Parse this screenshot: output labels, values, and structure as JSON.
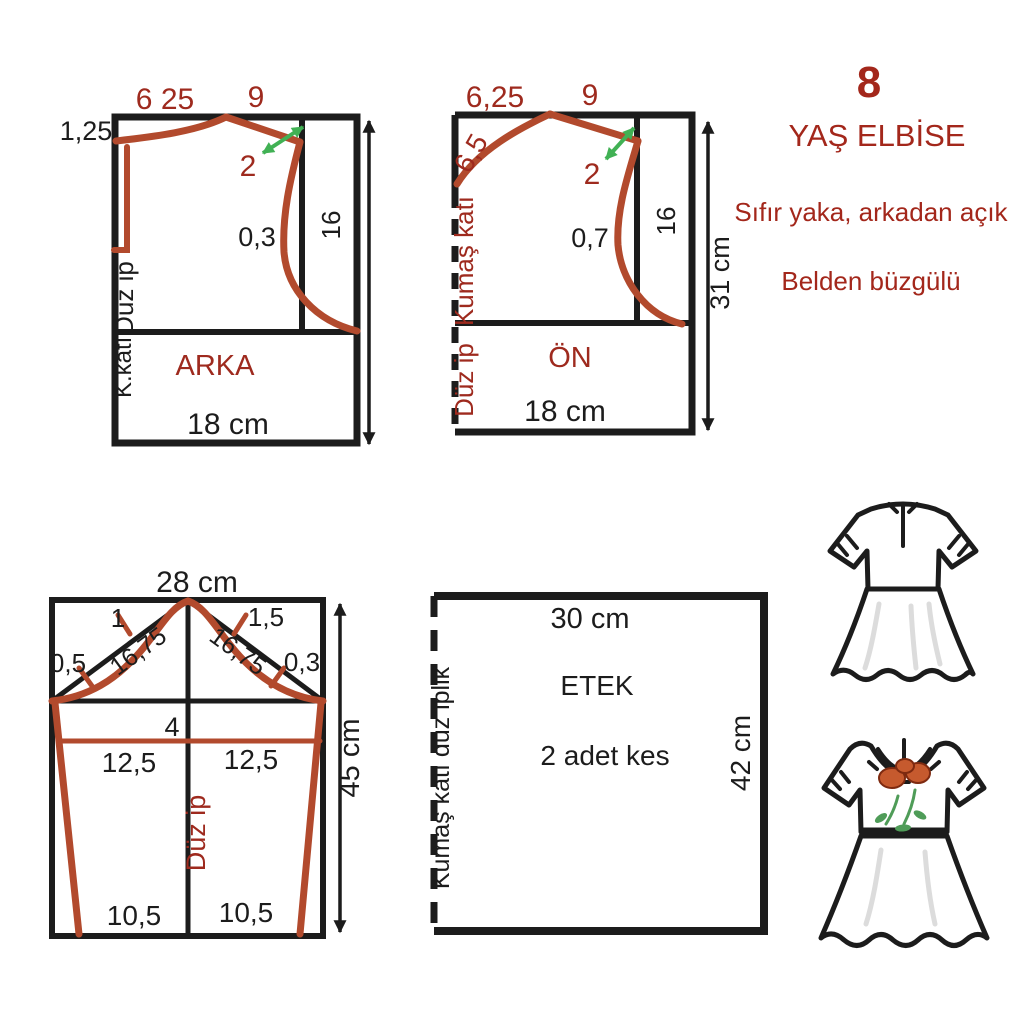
{
  "colors": {
    "ink": "#1c1c1c",
    "red-line": "#b24a2d",
    "red-text": "#9e2a1e",
    "title-red": "#a3271b",
    "green": "#41b154",
    "flower-red": "#c65a2e",
    "flower-green": "#4f9c58",
    "bg": "#ffffff"
  },
  "header": {
    "size_number": "8",
    "title": "YAŞ ELBİSE",
    "subtitle1": "Sıfır yaka, arkadan açık",
    "subtitle2": "Belden büzgülü"
  },
  "back_piece": {
    "name": "ARKA",
    "top_left": "6 25",
    "top_right": "9",
    "left_top": "1,25",
    "notch": "2",
    "armhole": "0,3",
    "side": "16",
    "grainline": "Düz ip",
    "fold": "K.katı.",
    "width": "18 cm"
  },
  "front_piece": {
    "name": "ÖN",
    "top_left": "6,25",
    "top_right": "9",
    "neck": "6,5",
    "notch": "2",
    "armhole": "0,7",
    "side": "16",
    "height": "31 cm",
    "fold": "Kumaş katı",
    "grainline": "Düz ip",
    "width": "18 cm"
  },
  "sleeve_piece": {
    "width": "28 cm",
    "cap_left": "1",
    "cap_right": "1,5",
    "edge_left": "0,5",
    "edge_right": "0,3",
    "diag_left": "16,75",
    "diag_right": "16,75",
    "bicep": "4",
    "mid_left": "12,5",
    "mid_right": "12,5",
    "grainline": "Düz ip",
    "hem_left": "10,5",
    "hem_right": "10,5",
    "height": "45 cm"
  },
  "skirt_piece": {
    "name": "ETEK",
    "width": "30 cm",
    "cut": "2 adet kes",
    "height": "42 cm",
    "fold": "Kumaş katı düz iplik"
  }
}
